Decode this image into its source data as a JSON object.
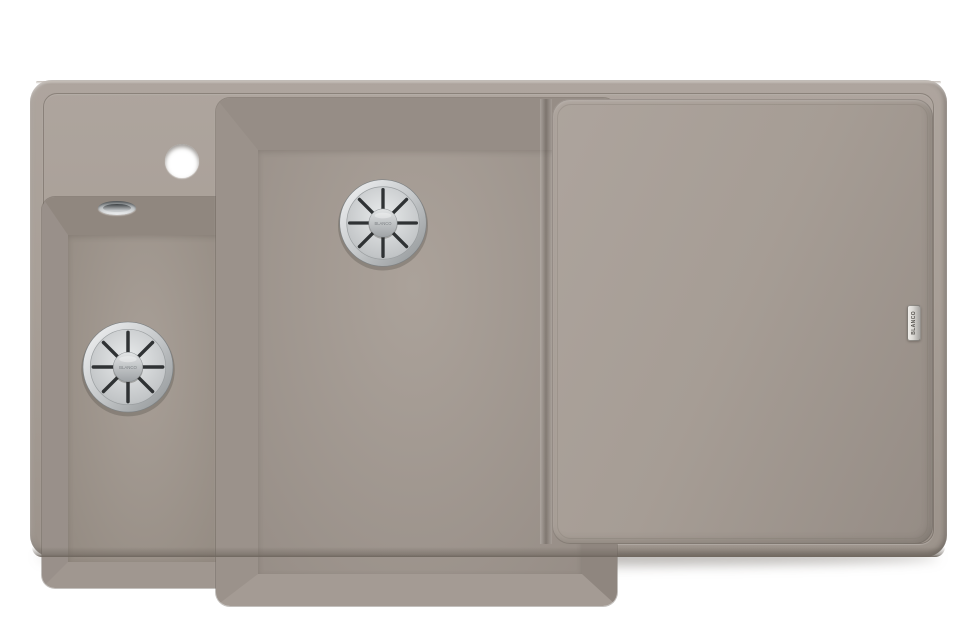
{
  "image": {
    "description": "Product photo of a one-and-a-half bowl composite kitchen sink with right-hand drainboard, taupe colored, on white background"
  },
  "colors": {
    "background": "#ffffff",
    "sink_top": "#aea59e",
    "sink_base": "#a89f97",
    "sink_bottom": "#9c938b",
    "edge_highlight": "#c3bcb5",
    "edge_dark": "#6f675f",
    "groove": "#80776f",
    "main_wall_top": "#968d86",
    "main_wall_left": "#9b928b",
    "main_wall_right": "#8f867f",
    "main_wall_bottom": "#a49b94",
    "main_floor_light": "#aba29a",
    "main_floor_dark": "#948b84",
    "small_wall_top": "#90877f",
    "small_wall_left": "#99908a",
    "small_wall_right": "#8d847e",
    "small_wall_bottom": "#a09790",
    "small_floor_light": "#a89f97",
    "small_floor_dark": "#928980",
    "board_light": "#ada49d",
    "board_mid": "#a69d95",
    "board_dark": "#958c85",
    "chrome_light": "#f4f5f6",
    "chrome_mid": "#c6c9cb",
    "chrome_dark": "#8e9294",
    "slot": "#2f3234",
    "tap_hole": "#ffffff",
    "badge_plate": "#dcdad6",
    "badge_text": "#55524e",
    "shadow": "rgba(104,98,92,0.45)"
  },
  "badge": {
    "text": "BLANCO"
  },
  "drains": {
    "count": 2,
    "cap_text": "BLANCO"
  }
}
